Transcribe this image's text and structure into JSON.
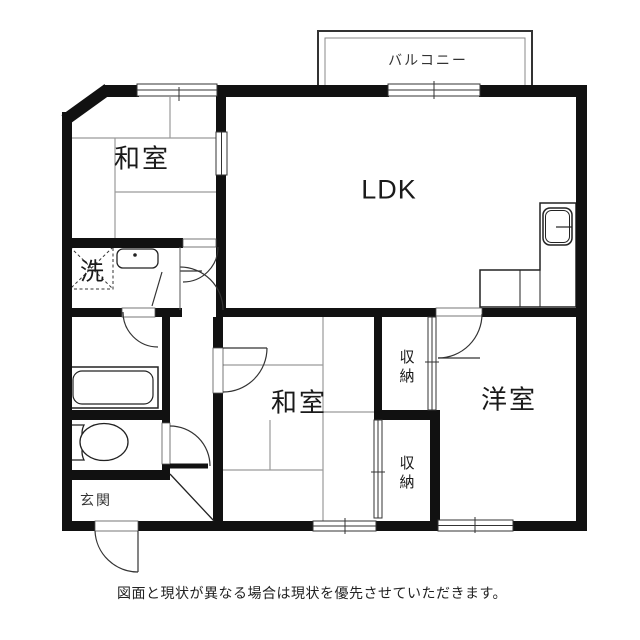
{
  "floorplan": {
    "rooms": {
      "washitsu_top": "和室",
      "ldk": "LDK",
      "washitsu_mid": "和室",
      "youshitsu": "洋室",
      "storage_top": "収納",
      "storage_bottom": "収納",
      "laundry": "洗",
      "genkan": "玄関",
      "balcony": "バルコニー"
    },
    "disclaimer": "図面と現状が異なる場合は現状を優先させていただきます。",
    "colors": {
      "wall": "#111111",
      "line": "#333333",
      "tatami_line": "#9a9a9a",
      "background": "#ffffff"
    },
    "fixtures": [
      "bathtub",
      "toilet",
      "kitchen-sink",
      "vanity-sink",
      "washing-machine"
    ]
  }
}
